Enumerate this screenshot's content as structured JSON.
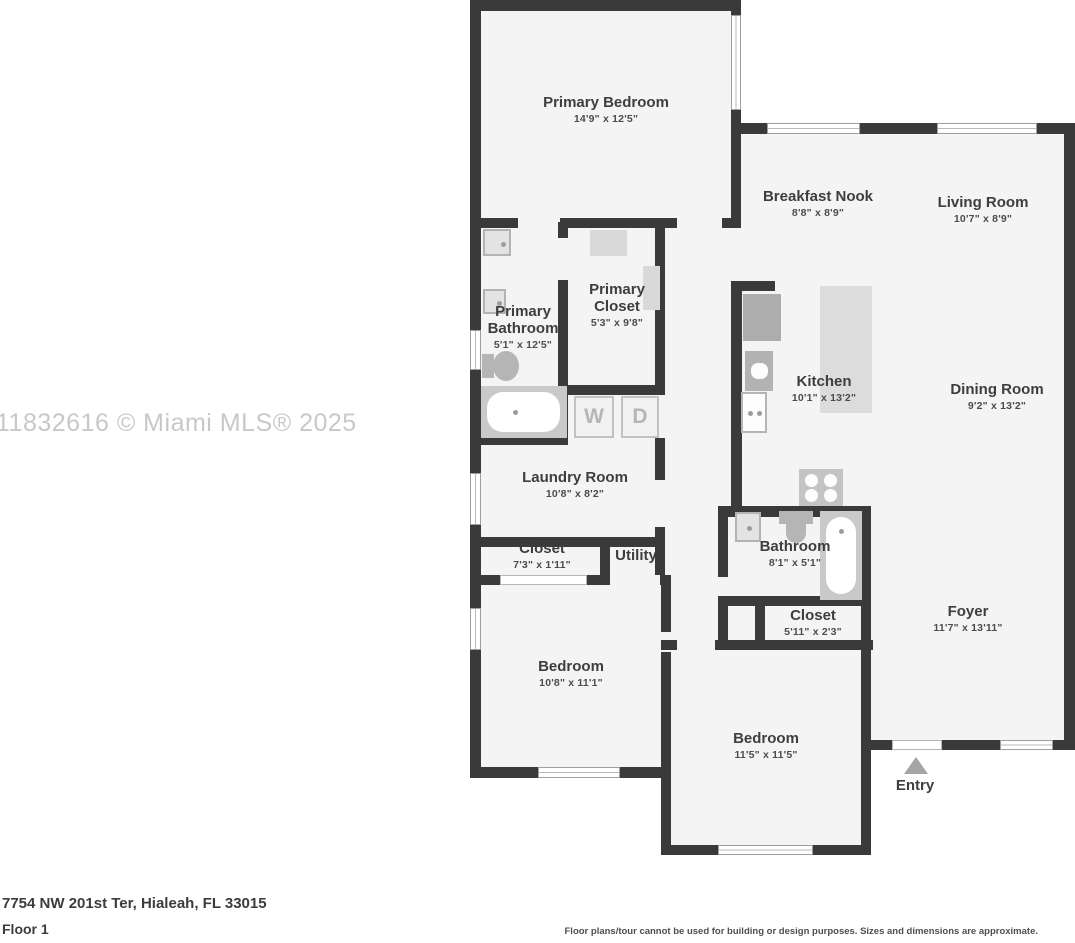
{
  "watermark": "11832616 © Miami MLS® 2025",
  "address": "7754 NW 201st Ter, Hialeah, FL 33015",
  "floor_label": "Floor 1",
  "disclaimer": "Floor plans/tour cannot be used for building or design purposes. Sizes and dimensions are approximate.",
  "entry_label": "Entry",
  "appliances": {
    "washer": "W",
    "dryer": "D"
  },
  "colors": {
    "wall": "#3a3a3a",
    "floor": "#f4f4f4",
    "fixture": "#c9c9c9",
    "watermark": "#c8c8c8"
  },
  "rooms": {
    "primary_bedroom": {
      "name": "Primary Bedroom",
      "dims": "14'9\" x 12'5\""
    },
    "breakfast_nook": {
      "name": "Breakfast Nook",
      "dims": "8'8\" x 8'9\""
    },
    "living_room": {
      "name": "Living Room",
      "dims": "10'7\" x 8'9\""
    },
    "primary_bathroom": {
      "name_line1": "Primary",
      "name_line2": "Bathroom",
      "dims": "5'1\" x 12'5\""
    },
    "primary_closet": {
      "name_line1": "Primary",
      "name_line2": "Closet",
      "dims": "5'3\" x 9'8\""
    },
    "kitchen": {
      "name": "Kitchen",
      "dims": "10'1\" x 13'2\""
    },
    "dining_room": {
      "name": "Dining Room",
      "dims": "9'2\" x 13'2\""
    },
    "laundry_room": {
      "name": "Laundry Room",
      "dims": "10'8\" x 8'2\""
    },
    "closet_hall": {
      "name": "Closet",
      "dims": "7'3\" x 1'11\""
    },
    "utility": {
      "name": "Utility"
    },
    "bathroom": {
      "name": "Bathroom",
      "dims": "8'1\" x 5'1\""
    },
    "closet_2": {
      "name": "Closet",
      "dims": "5'11\" x 2'3\""
    },
    "bedroom_1": {
      "name": "Bedroom",
      "dims": "10'8\" x 11'1\""
    },
    "bedroom_2": {
      "name": "Bedroom",
      "dims": "11'5\" x 11'5\""
    },
    "foyer": {
      "name": "Foyer",
      "dims": "11'7\" x 13'11\""
    }
  }
}
